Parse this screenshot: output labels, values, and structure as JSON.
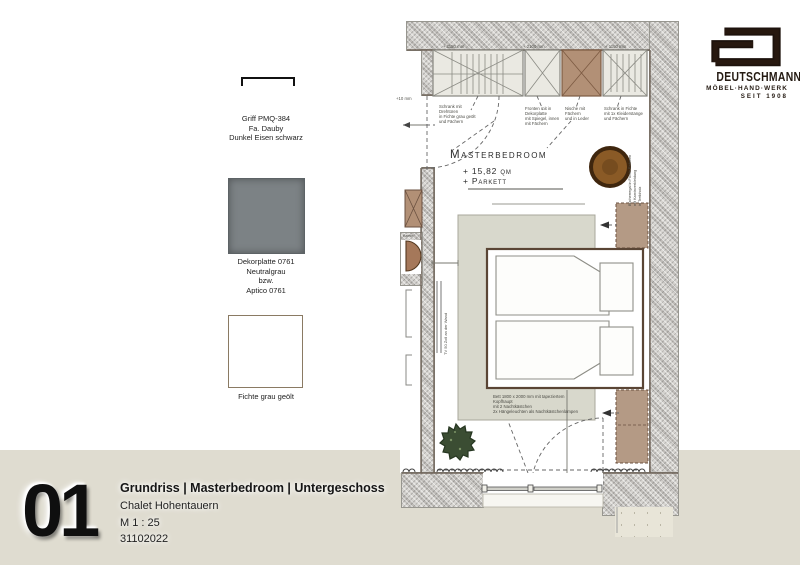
{
  "materials": {
    "handle": {
      "line1": "Griff PMQ-384",
      "line2": "Fa. Dauby",
      "line3": "Dunkel Eisen schwarz"
    },
    "decor": {
      "line1": "Dekorplatte 0761",
      "line2": "Neutralgrau",
      "line3": "bzw.",
      "line4": "Aptico 0761"
    },
    "wood": {
      "label": "Fichte grau geölt"
    }
  },
  "logo": {
    "brand": "DEUTSCHMANN",
    "craft": "MÖBEL·HAND·WERK",
    "since": "SEIT 1908"
  },
  "titleblock": {
    "number": "01",
    "title": "Grundriss | Masterbedroom | Untergeschoss",
    "project": "Chalet Hohentauern",
    "scale": "M 1 : 25",
    "date": "31102022"
  },
  "plan": {
    "room": {
      "name": "Masterbedroom",
      "area": "+ 15,82 qm",
      "floor": "+ Parkett"
    },
    "dims": {
      "d1": "+ 1150 mm",
      "d2": "+ 2100 mm",
      "d3": "+ 1150 mm",
      "level": "+10 mm"
    },
    "notes": {
      "w1a": "Schrank mit Drehtüren",
      "w1b": "in Fichte grau geölt",
      "w1c": "und Fächern",
      "w2a": "Fronten mit in Dekorplatte",
      "w2b": "mit Spiegel, innen",
      "w2c": "mit Fächern",
      "w3a": "Nische mit Fächern",
      "w3b": "und in Leder",
      "w4a": "Schrank in Fichte",
      "w4b": "mit 1x Kleiderstange",
      "w4c": "und Fächern",
      "beda": "Bett 1800 x 2000 mm mit tapeziertem Kopfhaupt",
      "bedb": "mit 2 Nachtkästchen",
      "bedc": "2x Hängeleuchten als Nachtkästchenlampen",
      "tv": "TV 50 Zoll an der Wand",
      "sidea": "Bücherregal in Fichte Rahmen",
      "sideb": "mit Kaminverkleidung",
      "sidec": "in Treibholz",
      "kamin": "Kamin"
    }
  },
  "colors": {
    "accentBrown": "#b29076",
    "wallGray": "#ccc9c4",
    "stripBeige": "#dfdcd0",
    "platform": "#d8d8cc"
  }
}
